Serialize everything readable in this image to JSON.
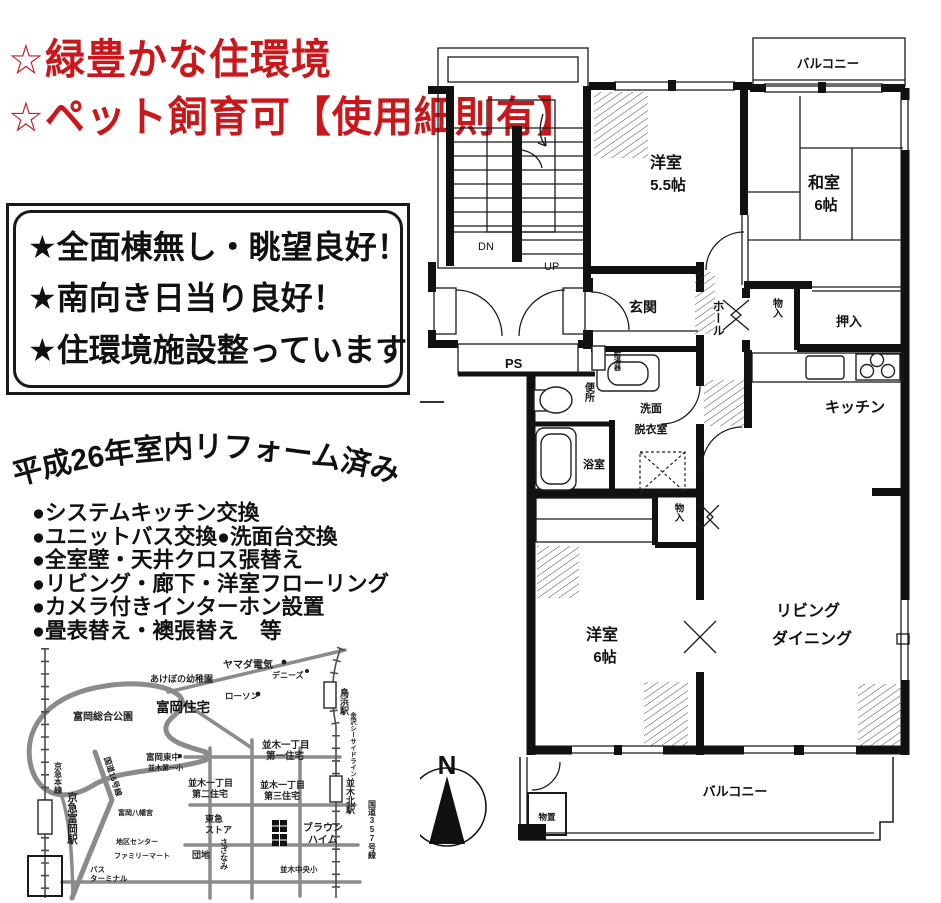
{
  "accent_color": "#c9181c",
  "header": {
    "line1": "☆緑豊かな住環境",
    "line2": "☆ペット飼育可【使用細則有】"
  },
  "highlight_box": {
    "lines": [
      "★全面棟無し・眺望良好！",
      "★南向き日当り良好！",
      "★住環境施設整っています"
    ]
  },
  "renovation": {
    "title": "平成26年室内リフォーム済み",
    "items": [
      "●システムキッチン交換",
      "●ユニットバス交換●洗面台交換",
      "●全室壁・天井クロス張替え",
      "●リビング・廊下・洋室フローリング",
      "●カメラ付きインターホン設置",
      "●畳表替え・襖張替え　等"
    ]
  },
  "floorplan": {
    "rooms": {
      "balcony_top": "バルコニー",
      "western55_name": "洋室",
      "western55_size": "5.5帖",
      "japanese_name": "和室",
      "japanese_size": "6帖",
      "entrance": "玄関",
      "hall": "ホール",
      "storage_upper": "物入",
      "oshiire": "押入",
      "kitchen": "キッチン",
      "water_heater": "給湯器",
      "toilet": "便所",
      "bath": "浴室",
      "washroom_line1": "洗面",
      "washroom_line2": "脱衣室",
      "storage_lower": "物入",
      "western6_name": "洋室",
      "western6_size": "6帖",
      "living_line1": "リビング",
      "living_line2": "ダイニング",
      "balcony_bottom": "バルコニー",
      "shed": "物置",
      "ps": "PS",
      "stairs_dn": "DN",
      "stairs_up": "UP"
    },
    "compass_north": "N"
  },
  "map": {
    "kindergarten": "あけぼの幼稚園",
    "yamada": "ヤマダ電気",
    "dennys": "デニーズ",
    "lawson": "ローソン",
    "tomioka_jutaku": "富岡住宅",
    "tomioka_park": "富岡総合公園",
    "tomioka_higashi": "富岡東中",
    "namiki_dai1sho": "並木第一小",
    "namiki1_1": "並木一丁目",
    "namiki1_2": "第一住宅",
    "namiki2_1": "並木一丁目",
    "namiki2_2": "第二住宅",
    "namiki3_1": "並木一丁目",
    "namiki3_2": "第三住宅",
    "tokyu_1": "東急",
    "tokyu_2": "ストア",
    "sazanami": "さざなみ",
    "danchi": "団地",
    "braun_1": "ブラウン",
    "braun_2": "ハイム",
    "namiki_chuo": "並木中央小",
    "torihama": "鳥浜駅",
    "seaside": "金沢シーサイドライン",
    "namiki_kita": "並木北駅",
    "r357": "国道357号線",
    "keikyu_line": "京急本線",
    "keikyu_sta": "京急富岡駅",
    "r16": "国道16号線",
    "bus_1": "バス",
    "bus_2": "ターミナル",
    "hachiman": "富岡八幡宮",
    "chiku_center": "地区センター",
    "familymart": "ファミリーマート"
  }
}
